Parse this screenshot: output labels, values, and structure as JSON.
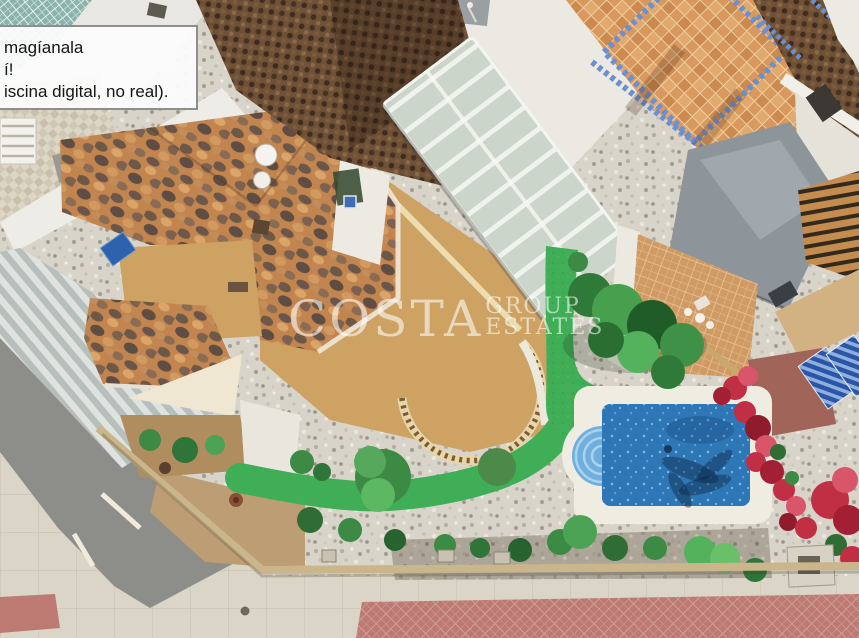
{
  "overlay_note": {
    "lines": [
      "magíanala",
      "í!",
      "iscina digital, no real)."
    ]
  },
  "watermark": {
    "primary": "COSTA",
    "secondary_top": "GROUP",
    "secondary_bottom": "ESTATES"
  },
  "palette": {
    "pool_water": "#2e77b6",
    "pool_steps": "#71aedd",
    "turf_green": "#3fae57",
    "gravel_light": "#d8d4ca",
    "terrace_tan": "#cda263",
    "roof_mottled": "#c28550",
    "roof_dark_woven": "#6f5138",
    "tile_terrace_orange": "#d9995e",
    "mosaic_blue": "#6b8fd0",
    "asphalt_grey": "#8d8d89",
    "sidewalk": "#dad5c7",
    "paving_red": "#bd7a72",
    "awning_grey": "#8d959b",
    "flowers_red": "#c12f44",
    "shrub_green": "#3c8a44",
    "sand_dirt": "#bd9d74"
  },
  "scene": {
    "label": "aerial-villa-with-pool-photo"
  }
}
